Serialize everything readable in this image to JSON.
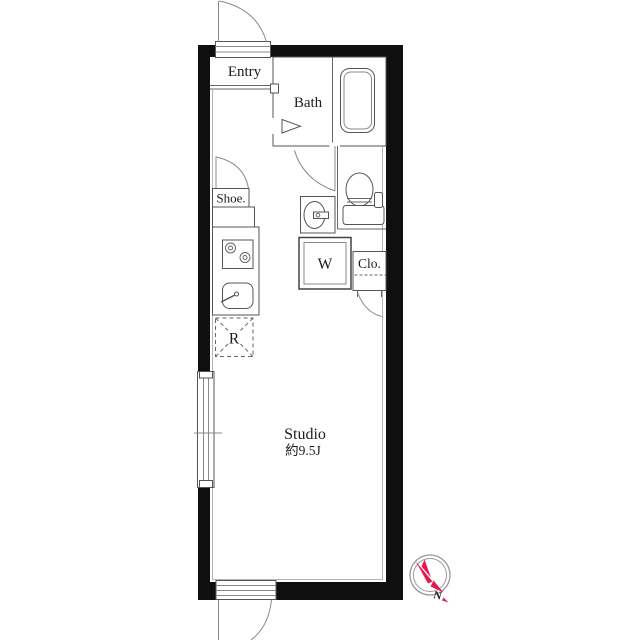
{
  "floorplan": {
    "rooms": {
      "entry": {
        "label": "Entry"
      },
      "bath": {
        "label": "Bath"
      },
      "shoe_cabinet": {
        "label": "Shoe."
      },
      "washer": {
        "label": "W"
      },
      "closet": {
        "label": "Clo."
      },
      "refrigerator": {
        "label": "R"
      },
      "studio": {
        "label": "Studio",
        "area": "約9.5J"
      }
    },
    "compass": {
      "label": "N",
      "needle_color": "#e6194f"
    },
    "colors": {
      "wall": "#0f0f0f",
      "line": "#666666"
    }
  }
}
